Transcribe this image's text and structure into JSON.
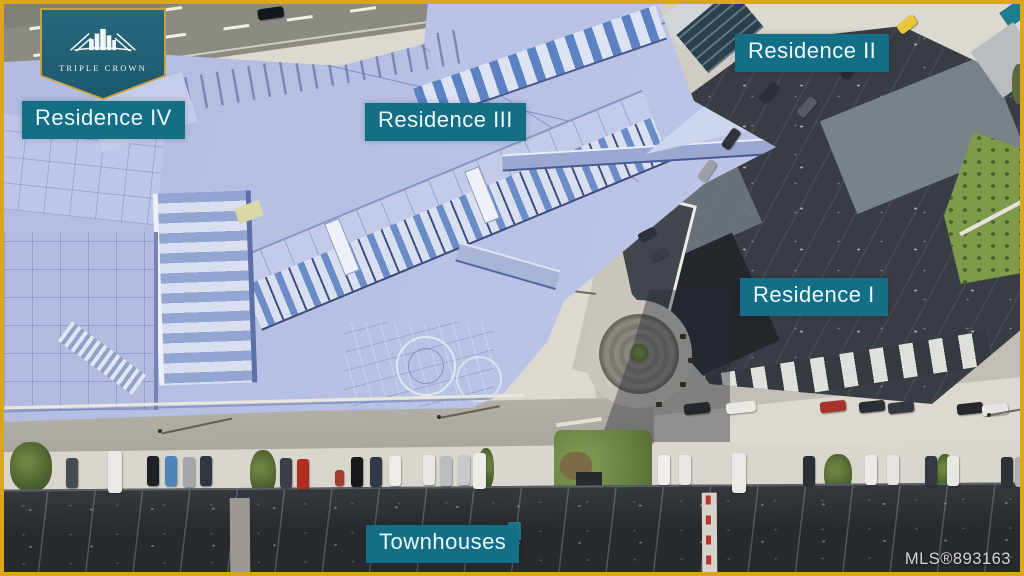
{
  "logo": {
    "brand": "TRIPLE CROWN",
    "icon": "city-skyline-crown-icon"
  },
  "labels": {
    "residence4": "Residence IV",
    "residence3": "Residence III",
    "residence2": "Residence II",
    "residence1": "Residence I",
    "townhouses": "Townhouses"
  },
  "watermark": {
    "mls": "MLS®893163"
  },
  "colors": {
    "frame_gold": "#d9a61d",
    "label_teal": "#146e86",
    "logo_teal": "#235e72",
    "logo_border_gold": "#c9a23a",
    "render_periwinkle": "#b7c0e3",
    "roof_charcoal": "#383d44",
    "townhouse_roof": "#26292e",
    "pavement": "#dcd9d0"
  }
}
